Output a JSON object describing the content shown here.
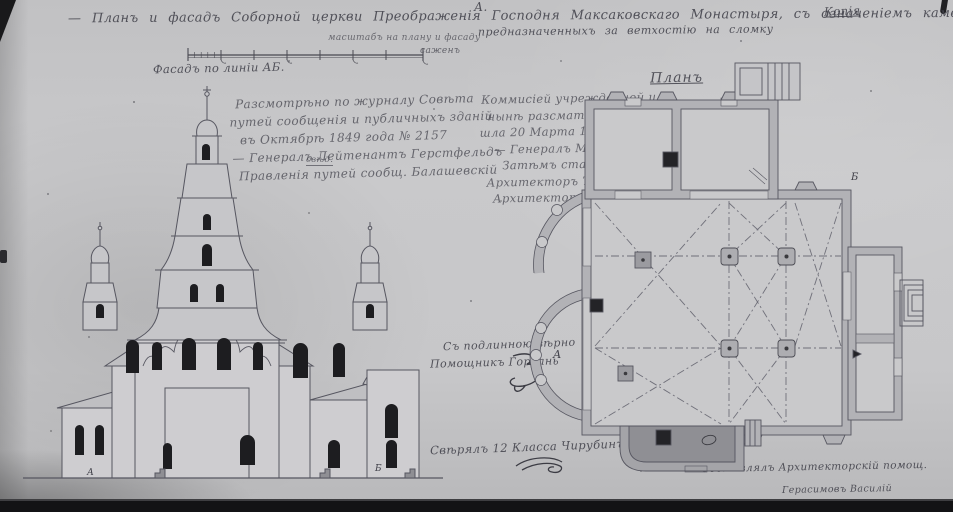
{
  "palette": {
    "paper": "#c7c7c9",
    "photo_edge": "#131315",
    "ink": "#41414a",
    "wall_fill": "#b2b2b6",
    "interior_fill": "#c9c9cb",
    "dark_pier": "#232327",
    "window_dark": "#1d1d20",
    "roof_fill": "#bfbfc2"
  },
  "title": {
    "line1": "— Планъ и фасадъ Соборной церкви Преображенія Господня Максаковскаго Монастыря, съ означеніемъ каменныхъ тушью покрытыхъ",
    "line2": "предназначенныхъ за ветхостію на сломку",
    "marker": "А.",
    "corner_word": "Копія"
  },
  "scale": {
    "note": "масштабъ на плану и фасаду",
    "unit": "саженъ"
  },
  "labels": {
    "facade": "Фасадъ по линіи АБ.",
    "plan": "Планъ"
  },
  "blocks": {
    "left": {
      "lines": [
        "Разсмотрѣно по журналу Совѣта",
        "путей сообщенія и публичныхъ зданій",
        "въ Октябрѣ 1849 года № 2157",
        "— Генералъ Лейтенантъ Герстфельдъ",
        "Правленія путей сообщ. Балашевскій"
      ],
      "insert": "свѣд."
    },
    "right": {
      "lines": [
        "Коммисіей учрежденной и",
        "нынѣ разсматривающей подъ",
        "шла 20 Марта 1847 № 1365",
        "— Генералъ Маіоръ Зегеръ",
        "Затѣмъ старшій",
        "Архитекторъ Тарнавскій",
        "Архитекторъ Вишневскій"
      ]
    },
    "certify": {
      "line1": "Съ подлинною вѣрно",
      "line2": "Помощникъ Горбань"
    },
    "verify": "Свѣрялъ 12 Класса Чирубинъ",
    "draftsman": {
      "line1": "Составлялъ Архитекторскій помощ.",
      "line2": "Герасимовъ Василій"
    }
  },
  "markers": {
    "facade_a": "А",
    "facade_b": "Б",
    "plan_a": "А",
    "plan_b": "Б"
  }
}
